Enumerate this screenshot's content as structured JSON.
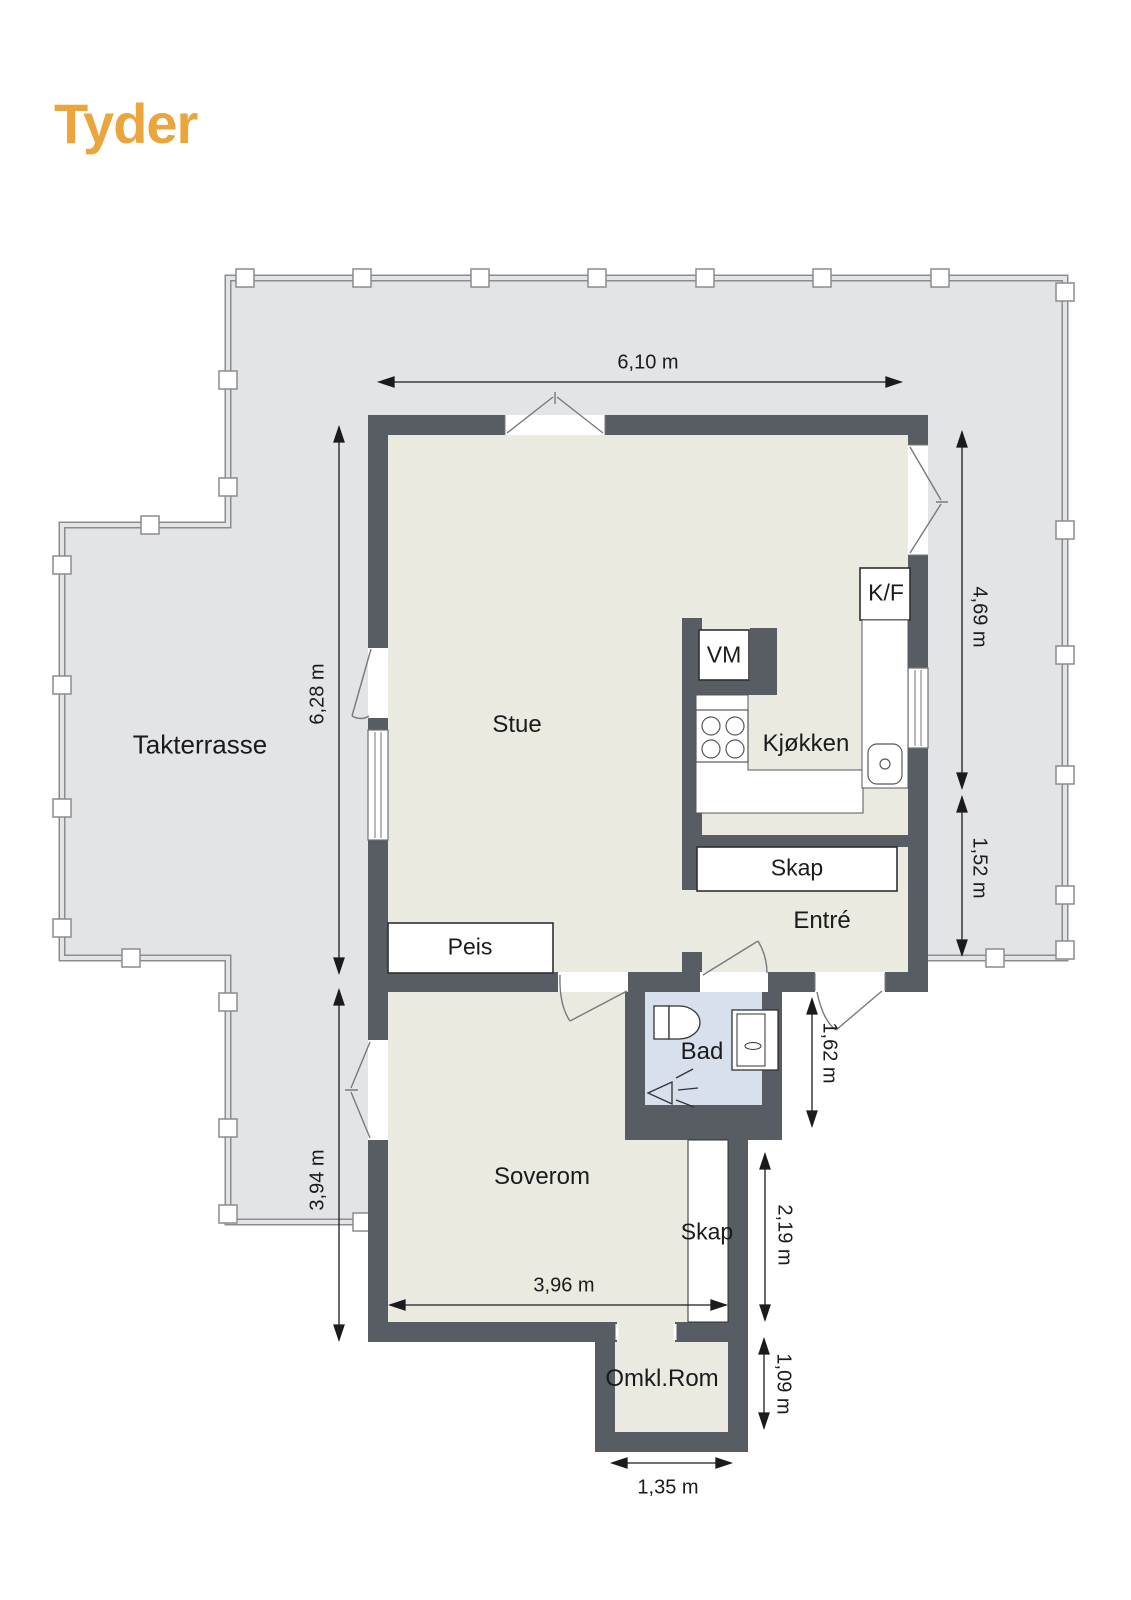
{
  "brand": {
    "name": "Tyder"
  },
  "rooms": {
    "terrace": "Takterrasse",
    "living": "Stue",
    "kitchen": "Kjøkken",
    "entry": "Entré",
    "bathroom": "Bad",
    "bedroom": "Soverom",
    "changing_room": "Omkl.Rom"
  },
  "fixtures": {
    "fireplace": "Peis",
    "entry_closet": "Skap",
    "bedroom_closet": "Skap",
    "washing_machine": "VM",
    "fridge_freezer": "K/F"
  },
  "dimensions": {
    "living_width": "6,10 m",
    "living_height": "6,28 m",
    "kitchen_side_height": "4,69 m",
    "entry_side_height": "1,52 m",
    "bedroom_height": "3,94 m",
    "bathroom_side_height": "1,62 m",
    "closet_side_height": "2,19 m",
    "changing_room_height": "1,09 m",
    "bedroom_width": "3,96 m",
    "changing_room_width": "1,35 m"
  },
  "colors": {
    "brand": "#EAA63C",
    "wall": "#585D63",
    "terrace_floor": "#E3E4E6",
    "room_floor": "#EAEAE1",
    "bathroom_floor": "#D9E0ED"
  }
}
